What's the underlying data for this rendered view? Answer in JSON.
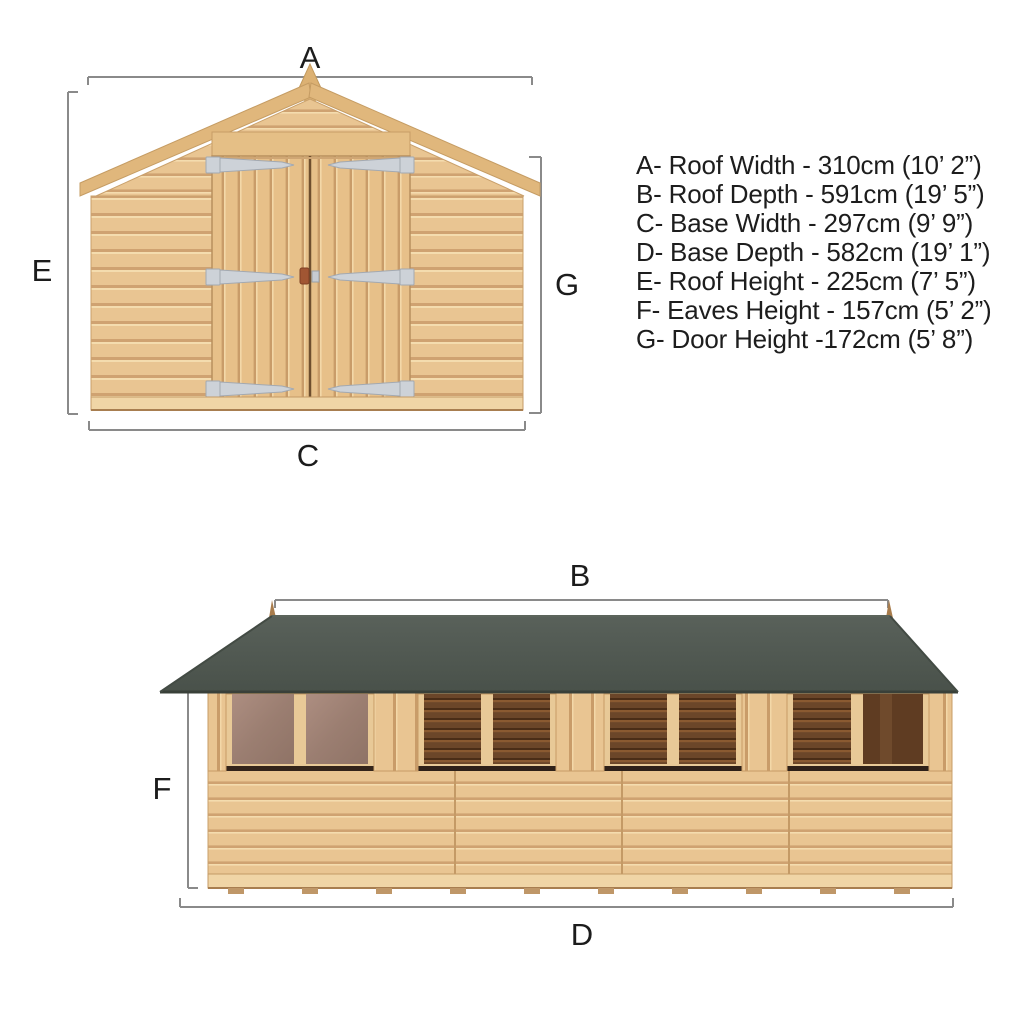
{
  "front": {
    "labels": {
      "a": "A",
      "c": "C",
      "e": "E",
      "g": "G"
    }
  },
  "side": {
    "labels": {
      "b": "B",
      "d": "D",
      "f": "F"
    }
  },
  "specs": [
    "A- Roof Width - 310cm (10’ 2”)",
    "B- Roof Depth - 591cm (19’ 5”)",
    "C- Base Width - 297cm (9’ 9”)",
    "D- Base Depth - 582cm (19’ 1”)",
    "E- Roof Height - 225cm (7’ 5”)",
    "F- Eaves Height - 157cm (5’ 2”)",
    "G- Door Height -172cm (5’ 8”)"
  ],
  "colors": {
    "wood": "#e9c592",
    "wood_shadow": "#cfa271",
    "wood_trim": "#e0b77c",
    "roof_felt": "#4f574f",
    "window_dark": "#6b4629",
    "window_glass": "#a28476",
    "hinge_silver": "#cdd2d8",
    "dimension_line": "#8a8a8a",
    "text": "#1d1d1d"
  }
}
